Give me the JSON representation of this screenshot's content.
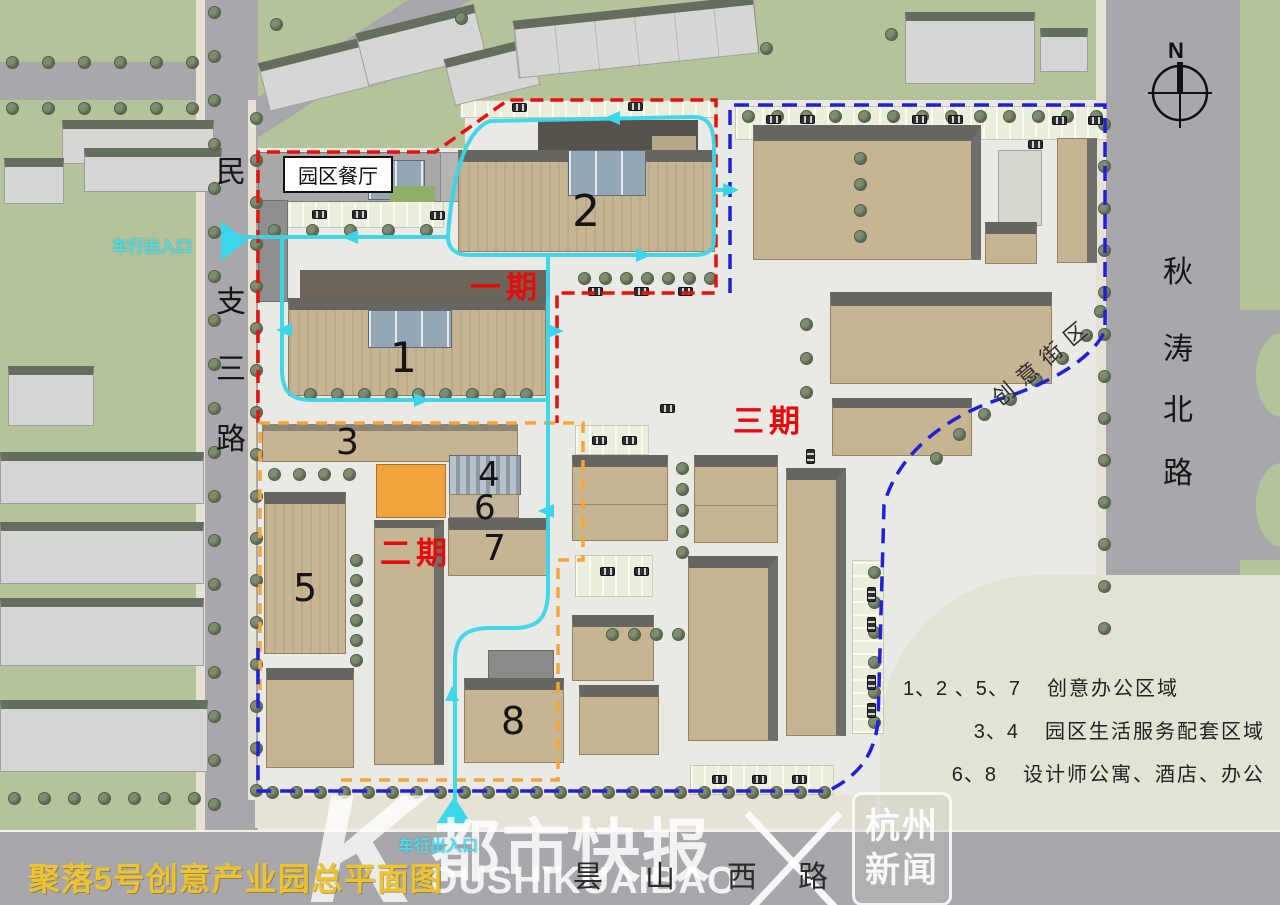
{
  "title": {
    "text": "聚落5号创意产业园总平面图"
  },
  "compass": {
    "label": "N"
  },
  "roads": {
    "west_chars": [
      "民",
      "支",
      "三",
      "路"
    ],
    "east_chars": [
      "秋",
      "涛",
      "北",
      "路"
    ],
    "south_chars": [
      "昙",
      "山",
      "西",
      "路"
    ],
    "creative_street": "创意街区"
  },
  "phases": {
    "phase1": "一期",
    "phase2": "二期",
    "phase3": "三期"
  },
  "buildings": {
    "b1": "1",
    "b2": "2",
    "b3": "3",
    "b4": "4",
    "b5": "5",
    "b6": "6",
    "b7": "7",
    "b8": "8"
  },
  "labels": {
    "restaurant": "园区餐厅",
    "entrance_west": "车行出入口",
    "entrance_south": "车行出入口"
  },
  "legend": {
    "rows": [
      {
        "nums": "1、2 、5、7",
        "label": "创意办公区域"
      },
      {
        "nums": "3、4",
        "label": "园区生活服务配套区域"
      },
      {
        "nums": "6、8",
        "label": "设计师公寓、酒店、办公"
      }
    ]
  },
  "watermark": {
    "k": "K",
    "cn": "都市快报",
    "en": "DUSHIKUAIBAO",
    "right_line1": "杭州",
    "right_line2": "新闻"
  },
  "colors": {
    "phase1_red": "#e8100c",
    "phase2_orange": "#f2a738",
    "phase3_blue": "#2020d8",
    "route_cyan": "#3bd6ea",
    "title_yellow": "#edc42e",
    "building_tan": "#c6b493",
    "accent_building_orange": "#f0a33c",
    "surround_green": "#b5c39b",
    "road_gray": "#a8a8ac"
  }
}
